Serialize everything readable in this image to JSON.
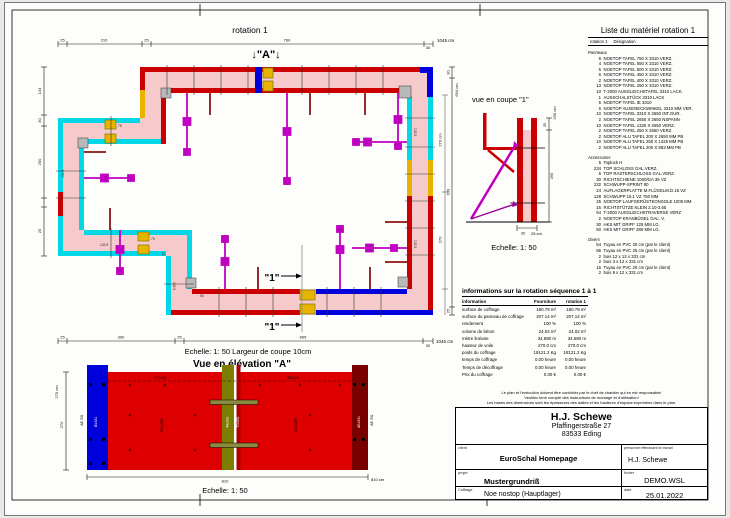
{
  "colors": {
    "wall_fill": "#f6caca",
    "red": "#cc0000",
    "dark_red": "#8b1515",
    "cyan": "#00d8e8",
    "magenta": "#c000c0",
    "blue": "#0000dd",
    "yellow": "#e8b400",
    "olive": "#7d7d00",
    "maroon": "#7a0000",
    "elev_red": "#de0000",
    "gray": "#b8b8b8"
  },
  "plan": {
    "title": "rotation 1",
    "marker_a": "↓\"A\"↓",
    "marker_1": "\"1\"",
    "scale_note": "Echelle: 1: 50   Largeur de coupe 10cm",
    "dims_top": [
      "25",
      "210",
      "25",
      "760",
      "30"
    ],
    "dim_top_total": "1045 cm",
    "dims_bottom": [
      "25",
      "300",
      "25",
      "665",
      "30"
    ],
    "dim_bottom_total": "1045 cm",
    "dims_left": [
      "134",
      "30",
      "200",
      "25"
    ],
    "dims_right": [
      "30",
      "694 cm",
      "270 cm",
      "270",
      "639",
      "25"
    ],
    "lbl_1325": "132.5",
    "lbl_75": "75",
    "lbl_12": "12",
    "lbl_50": "50"
  },
  "section": {
    "title": "vue en coupe \"1\"",
    "scale": "Echelle: 1: 50",
    "dims": {
      "total": "290 cm",
      "top": "25",
      "main": "265",
      "base_a": "30",
      "base_b": "25 cm"
    }
  },
  "elevation": {
    "title": "Vue en élévation \"A\"",
    "scale": "Echelle: 1: 50",
    "labels": {
      "top_left": "331x25",
      "top_right": "331x25",
      "panel_left": "331x265",
      "panel_right": "331x265",
      "center": "48x331",
      "center2": "70x331",
      "left_in": "IEx331",
      "right_in": "AEx331",
      "left_out": "AE 331",
      "right_out": "AE 331"
    },
    "dims": {
      "h1": "270 cm",
      "h2": "270",
      "w": "810",
      "w_total": "810 cm"
    }
  },
  "material_list": {
    "title": "Liste du matériel  rotation 1",
    "col1": "rotation 1",
    "col2": "Désignation",
    "groups": [
      {
        "name": "Panneaux",
        "items": [
          {
            "qty": "6",
            "name": "NOETOP TAFEL 750 X 3310 VERZ."
          },
          {
            "qty": "4",
            "name": "NOETOP TAFEL 550 X 3310 VERZ."
          },
          {
            "qty": "6",
            "name": "NOETOP TAFEL 500 X 3310 VERZ."
          },
          {
            "qty": "6",
            "name": "NOETOP TAFEL 450 X 3310 VERZ."
          },
          {
            "qty": "2",
            "name": "NOETOP TAFEL 400 X 3310 VERZ."
          },
          {
            "qty": "13",
            "name": "NOETOP TAFEL 250 X 3310 VERZ."
          },
          {
            "qty": "10",
            "name": "T-2000 AUSGLEICHSTAFEL 3310 LACK."
          },
          {
            "qty": "1",
            "name": "AUSSCHALSTÜCK 3310 LACK"
          },
          {
            "qty": "6",
            "name": "NOETOP TAFEL IE 3310"
          },
          {
            "qty": "6",
            "name": "NOETOP AUSENECKWINKEL 3310 MM VER."
          },
          {
            "qty": "10",
            "name": "NOETOP TAFEL 3310 X 2650 INT.GUR."
          },
          {
            "qty": "2",
            "name": "NOETOP TAFEL 2650 X 2650 NSPANN"
          },
          {
            "qty": "10",
            "name": "NOETOP TAFEL 1325 X 2650 VERZ."
          },
          {
            "qty": "2",
            "name": "NOETOP TAFEL 250 X 2650 VERZ."
          },
          {
            "qty": "2",
            "name": "NOETOP ALU TAFEL 200 X 2650 MM PB"
          },
          {
            "qty": "10",
            "name": "NOETOP ALU TAFEL 250 X 1325 MM PB"
          },
          {
            "qty": "2",
            "name": "NOETOP ALU TAFEL 200 X 883 MM PB"
          }
        ]
      },
      {
        "name": "Accessoires",
        "items": [
          {
            "qty": "5",
            "name": "Toplock H"
          },
          {
            "qty": "234",
            "name": "TOP SCHLOSS GAL.VERZ."
          },
          {
            "qty": "6",
            "name": "TOP RASTERSCHLOSS GAL.VERZ."
          },
          {
            "qty": "30",
            "name": "RICHTSCHIENE 1000/GA 35 VZ"
          },
          {
            "qty": "232",
            "name": "SCHWUPP-SPRINT 80"
          },
          {
            "qty": "24",
            "name": "AUFLAGERPLATTE M.FLÜGELM.D.15 VZ"
          },
          {
            "qty": "128",
            "name": "SCHWUPP 15.1  VZ  750 MM"
          },
          {
            "qty": "25",
            "name": "NOETOP LAUFGERÜSTKONSOLE 1000 MM"
          },
          {
            "qty": "16",
            "name": "RICHTSTÜTZE KLEIN 2.10-3.65"
          },
          {
            "qty": "54",
            "name": "T-2000 AUSGLEICHSTRAVERSE VERZ"
          },
          {
            "qty": "2",
            "name": "NOETOP KRANBÜGEL GAL. V."
          },
          {
            "qty": "30",
            "name": "HKS MIT GRIFF 125 MM LG."
          },
          {
            "qty": "50",
            "name": "HKS MIT GRIFF 280 MM LG."
          }
        ]
      },
      {
        "name": "Divers",
        "items": [
          {
            "qty": "54",
            "name": "Tuyau en PVC 30 cm (par le client)"
          },
          {
            "qty": "86",
            "name": "Tuyau en PVC 25 cm (par le client)"
          },
          {
            "qty": "2",
            "name": "bois 12 x 12 x 331 cm"
          },
          {
            "qty": "2",
            "name": "bois 3 x 12 x 331 cm"
          },
          {
            "qty": "16",
            "name": "Tuyau en PVC 20 cm (par le client)"
          },
          {
            "qty": "2",
            "name": "bois 9 x 12 x 331 cm"
          }
        ]
      }
    ]
  },
  "info_table": {
    "title": "informations sur la rotation  séquence 1 à 1",
    "columns": [
      "information",
      "Fourniture",
      "rotation 1"
    ],
    "rows": [
      [
        "surface de coffrage",
        "180.79 m²",
        "180.79 m²"
      ],
      [
        "surface du panneau de coffrage",
        "207.14 m²",
        "207.14 m²"
      ],
      [
        "rendement",
        "100 %",
        "100 %"
      ],
      [
        "volume de béton",
        "24.02 m³",
        "24.02 m³"
      ],
      [
        "mètre linéaire",
        "34.580 m",
        "34.580 m"
      ],
      [
        "hauteur de voile",
        "270.0 cm",
        "270.0 cm"
      ],
      [
        "poids du coffrage",
        "18121.2 Kg",
        "18121.2 Kg"
      ],
      [
        "temps de coffrage",
        "0.00 heure",
        "0.00 heure"
      ],
      [
        "Temps de décoffrage",
        "0.00 heure",
        "0.00 heure"
      ],
      [
        "Prix du coffrage",
        "0.00 €",
        "0.00 €"
      ]
    ]
  },
  "disclaimer": [
    "Le plan et l'exécution doivent être contrôlés par le chef de chantier qui en est responsable!",
    "Veuillez tenir compte des instructions de montage et d'utilisation!",
    "Les bases des dimensions sont les épaisseurs des dalles et les hauteurs d'espace exprimées dans le plan."
  ],
  "title_block": {
    "company": "H.J. Schewe",
    "address1": "Pfaffingerstraße 27",
    "address2": "83533 Eding",
    "client_label": "client",
    "client": "EuroSchal Homepage",
    "person_label": "personne effectuant le travail",
    "person": "H.J. Schewe",
    "project_label": "projet",
    "project": "Mustergrundriß",
    "file_label": "fichier",
    "file": "DEMO.WSL",
    "formwork_label": "Coffrage",
    "formwork": "Noe nostop (Hauptlager)",
    "date_label": "date",
    "date": "25.01.2022"
  }
}
